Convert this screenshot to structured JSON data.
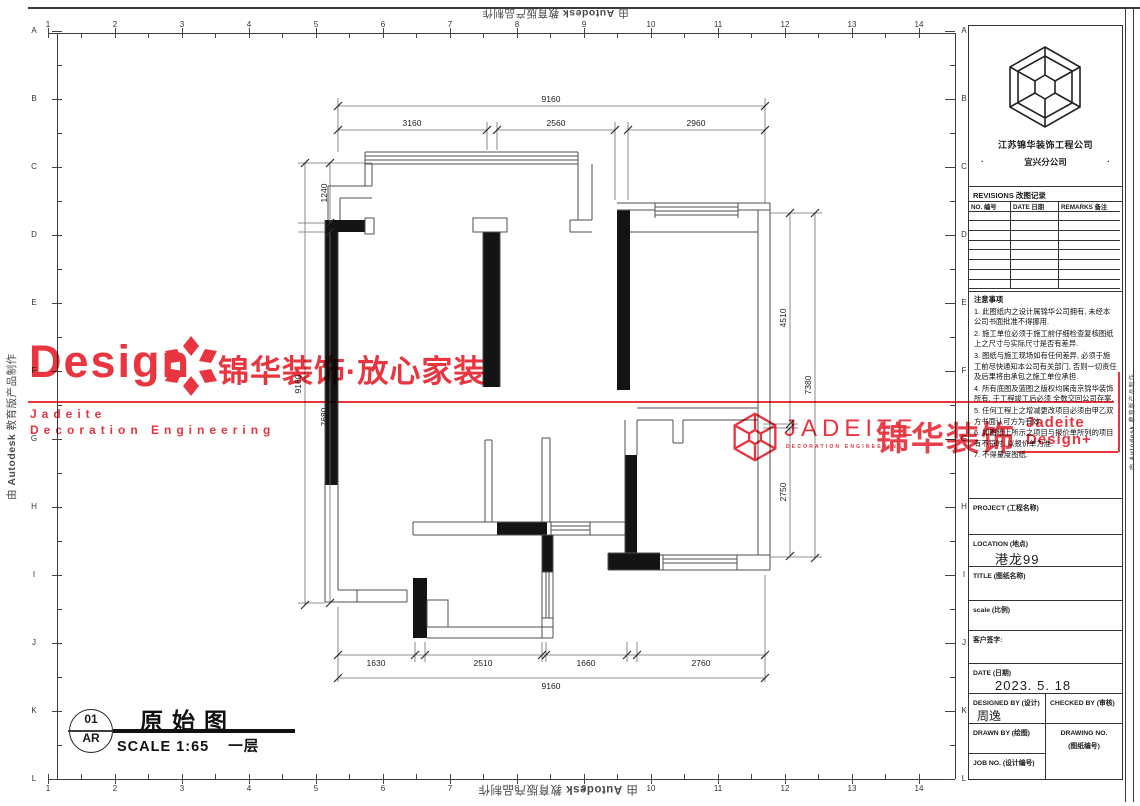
{
  "frame": {
    "grid_numbers": [
      "1",
      "2",
      "3",
      "4",
      "5",
      "6",
      "7",
      "8",
      "9",
      "10",
      "11",
      "12",
      "13",
      "14"
    ],
    "grid_letters": [
      "A",
      "B",
      "C",
      "D",
      "E",
      "F",
      "G",
      "H",
      "I",
      "J",
      "K",
      "L"
    ]
  },
  "edge_watermark": {
    "prefix": "由 ",
    "brand": "Autodesk",
    "suffix": " 教育版产品制作"
  },
  "watermark_left": {
    "design": "Design",
    "brand_cn": "锦华装饰·放心家装",
    "line1": "Jadeite",
    "line2": "Decoration Engineering",
    "color": "#e8353f"
  },
  "watermark_right": {
    "brand": "JADEITE",
    "sub": "DECORATION ENGINEERING",
    "brand_cn": "锦华装饰",
    "overlay1": "Jadeite",
    "overlay2": "Design+"
  },
  "title_block": {
    "company": "江苏锦华装饰工程公司",
    "branch": "宜兴分公司",
    "dot": "·",
    "revisions_title": "REVISIONS 改图记录",
    "rev_cols": [
      "NO. 编号",
      "DATE 日期",
      "REMARKS 备注"
    ],
    "notes_title": "注意事项",
    "notes": [
      "1. 此图纸内之设计属锦华公司拥有, 未经本公司书面批准不得挪用.",
      "2. 施工单位必须于施工前仔细检查复核图纸上之尺寸与实际尺寸是否有差异.",
      "3. 图纸与施工现场如有任何差异, 必须于施工前尽快通知本公司有关部门, 否则一切责任及后果将由承包之施工单位承担.",
      "4. 所有底图及蓝图之版权均属南京锦华装饰所有, 于工程竣工后必须 全数交回公司存案.",
      "5. 任何工程上之增减更改项目必须由甲乙双方书面认可方为有效.",
      "6. 如图纸上所示之项目与报价单所列的项目有不符时, 以报价单为准.",
      "7. 不得量度图纸."
    ],
    "project_label": "PROJECT (工程名称)",
    "location_label": "LOCATION (地点)",
    "location_value": "港龙99",
    "title_label": "TITLE (图纸名称)",
    "scale_label": "scale (比例)",
    "sign_label": "客户签字:",
    "date_label": "DATE (日期)",
    "date_value": "2023. 5. 18",
    "designed_label": "DESIGNED BY (设计)",
    "designed_value": "周逸",
    "checked_label": "CHECKED BY (审核)",
    "drawn_label": "DRAWN BY (绘图)",
    "drawing_no_label1": "DRAWING NO.",
    "drawing_no_label2": "(图纸编号)",
    "job_label": "JOB NO. (设计编号)"
  },
  "drawing_label": {
    "number": "01",
    "code": "AR",
    "title": "原始图",
    "scale": "SCALE 1:65",
    "floor": "一层"
  },
  "dims": {
    "top_overall": "9160",
    "top_seg": [
      "3160",
      "2560",
      "2960"
    ],
    "bottom_seg": [
      "1630",
      "2510",
      "1660",
      "2760"
    ],
    "bottom_overall": "9160",
    "left_overall": "9160",
    "left_seg": [
      "1240",
      "7680"
    ],
    "right_seg": [
      "4510",
      "2750"
    ],
    "right_overall": "7380"
  }
}
